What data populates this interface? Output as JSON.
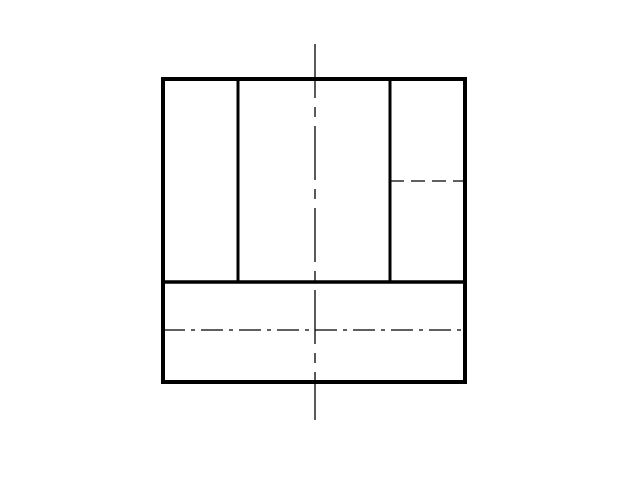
{
  "canvas": {
    "width": 640,
    "height": 480,
    "background_color": "#ffffff",
    "line_color": "#000000"
  },
  "drawing": {
    "rects": [
      {
        "name": "outer-outline",
        "x": 163,
        "y": 79,
        "w": 302,
        "h": 303,
        "stroke": 4,
        "dash": ""
      }
    ],
    "lines": [
      {
        "name": "view-divider-line",
        "x1": 161,
        "y1": 282,
        "x2": 465,
        "y2": 282,
        "stroke": 3.5,
        "dash": ""
      },
      {
        "name": "upper-left-divider-line",
        "x1": 238,
        "y1": 79,
        "x2": 238,
        "y2": 282,
        "stroke": 3,
        "dash": ""
      },
      {
        "name": "upper-right-divider-line",
        "x1": 390,
        "y1": 79,
        "x2": 390,
        "y2": 282,
        "stroke": 3,
        "dash": ""
      },
      {
        "name": "hidden-edge-line",
        "x1": 390,
        "y1": 181,
        "x2": 465,
        "y2": 181,
        "stroke": 1.3,
        "dash": "14 7"
      },
      {
        "name": "vertical-centerline",
        "x1": 315,
        "y1": 44,
        "x2": 315,
        "y2": 420,
        "stroke": 1.3,
        "dash": "54 9 10 9"
      },
      {
        "name": "horizontal-centerline",
        "x1": 163,
        "y1": 330,
        "x2": 465,
        "y2": 330,
        "stroke": 1.3,
        "dash": "22 6 4 6"
      }
    ]
  }
}
